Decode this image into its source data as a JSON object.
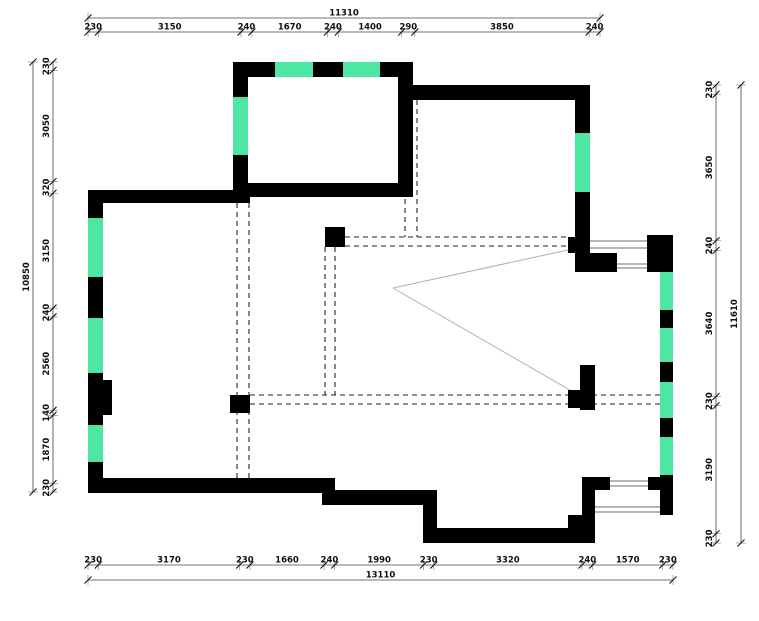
{
  "page": {
    "type": "architectural-floor-plan"
  },
  "colors": {
    "wall": "#000000",
    "window": "#4ee6a3",
    "dim_line": "#444444",
    "dim_guide": "#777777",
    "tick": "#111111",
    "dashed": "#222222",
    "thin_window_line": "#8a8a8a",
    "diagonal": "#b0b0b0",
    "background": "#ffffff"
  },
  "dimensions": {
    "top": {
      "total": "11310",
      "segments": [
        "230",
        "3150",
        "240",
        "1670",
        "240",
        "1400",
        "290",
        "3850",
        "240"
      ],
      "x0": 88,
      "x1": 600,
      "total_y": 18,
      "seg_y": 32
    },
    "bottom": {
      "total": "13110",
      "segments": [
        "230",
        "3170",
        "230",
        "1660",
        "240",
        "1990",
        "230",
        "3320",
        "240",
        "1570",
        "230"
      ],
      "x0": 88,
      "x1": 673,
      "seg_y": 565,
      "total_y": 580
    },
    "left": {
      "total": "10850",
      "segments": [
        "230",
        "3050",
        "320",
        "3150",
        "240",
        "2560",
        "140",
        "1870",
        "230"
      ],
      "y0": 62,
      "y1": 492,
      "total_x": 33,
      "seg_x": 53
    },
    "right": {
      "total": "11610",
      "segments": [
        "230",
        "3650",
        "240",
        "3640",
        "230",
        "3190",
        "230"
      ],
      "y0": 85,
      "y1": 543,
      "seg_x": 716,
      "total_x": 741
    }
  },
  "plan": {
    "walls": [
      [
        233,
        62,
        180,
        15
      ],
      [
        233,
        62,
        15,
        141
      ],
      [
        88,
        190,
        162,
        13
      ],
      [
        88,
        190,
        15,
        303
      ],
      [
        103,
        380,
        9,
        35
      ],
      [
        248,
        183,
        165,
        14
      ],
      [
        398,
        62,
        15,
        135
      ],
      [
        398,
        85,
        192,
        15
      ],
      [
        575,
        85,
        15,
        187
      ],
      [
        568,
        237,
        10,
        16
      ],
      [
        585,
        253,
        32,
        19
      ],
      [
        647,
        235,
        26,
        37
      ],
      [
        660,
        272,
        13,
        243
      ],
      [
        582,
        477,
        13,
        66
      ],
      [
        582,
        477,
        28,
        13
      ],
      [
        648,
        477,
        25,
        13
      ],
      [
        430,
        528,
        165,
        15
      ],
      [
        568,
        515,
        15,
        14
      ],
      [
        423,
        490,
        14,
        53
      ],
      [
        322,
        490,
        115,
        15
      ],
      [
        322,
        478,
        13,
        27
      ],
      [
        88,
        478,
        247,
        15
      ],
      [
        580,
        365,
        15,
        45
      ],
      [
        568,
        390,
        12,
        18
      ],
      [
        325,
        227,
        20,
        20
      ],
      [
        230,
        395,
        20,
        18
      ]
    ],
    "windows": [
      [
        275,
        62,
        38,
        15
      ],
      [
        343,
        62,
        37,
        15
      ],
      [
        233,
        97,
        15,
        58
      ],
      [
        88,
        218,
        15,
        59
      ],
      [
        88,
        318,
        15,
        55
      ],
      [
        88,
        425,
        15,
        37
      ],
      [
        575,
        133,
        15,
        59
      ],
      [
        660,
        272,
        13,
        38
      ],
      [
        660,
        328,
        13,
        34
      ],
      [
        660,
        382,
        13,
        36
      ],
      [
        660,
        437,
        13,
        38
      ]
    ],
    "thin_lines": [
      [
        590,
        241,
        649,
        241
      ],
      [
        590,
        248,
        649,
        248
      ],
      [
        617,
        264,
        647,
        264
      ],
      [
        617,
        268,
        647,
        268
      ],
      [
        610,
        481,
        648,
        481
      ],
      [
        610,
        486,
        648,
        486
      ],
      [
        595,
        507,
        660,
        507
      ],
      [
        595,
        512,
        660,
        512
      ]
    ],
    "dashed_lines": [
      [
        237,
        203,
        237,
        478
      ],
      [
        249,
        203,
        249,
        478
      ],
      [
        325,
        247,
        325,
        395
      ],
      [
        335,
        247,
        335,
        395
      ],
      [
        405,
        100,
        405,
        237
      ],
      [
        417,
        100,
        417,
        237
      ],
      [
        345,
        237,
        568,
        237
      ],
      [
        345,
        246,
        568,
        246
      ],
      [
        250,
        395,
        660,
        395
      ],
      [
        250,
        404,
        660,
        404
      ]
    ],
    "diagonals": [
      [
        393,
        288,
        568,
        250
      ],
      [
        393,
        288,
        582,
        397
      ]
    ]
  }
}
